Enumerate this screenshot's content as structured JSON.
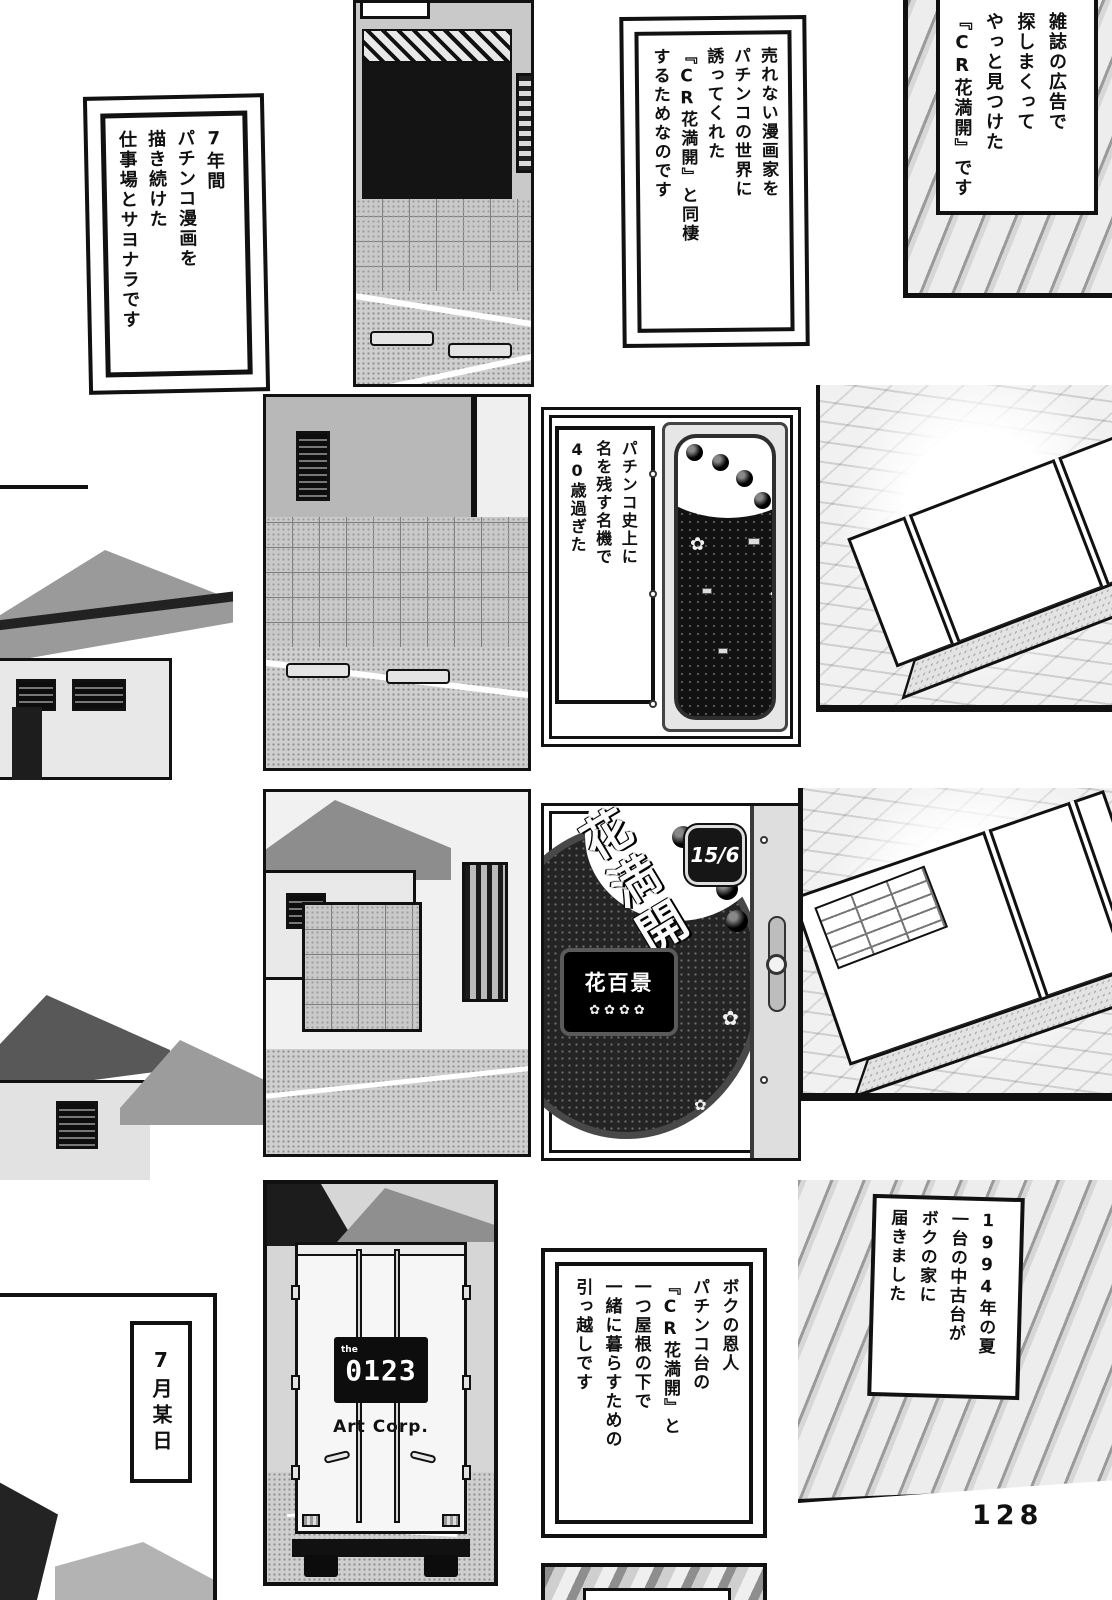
{
  "page": {
    "number": "128"
  },
  "colors": {
    "ink": "#111111",
    "paper": "#ffffff",
    "halftone_gray": "#c9c9c9",
    "dark_fill": "#1c1c1c"
  },
  "captions": {
    "magazine": "雑誌の広告で\n探しまくって\nやっと見つけた\n『CR花満開』です",
    "cohabit": "売れない漫画家を\nパチンコの世界に\n誘ってくれた\n『CR花満開』と同棲\nするためなのです",
    "goodbye": "7年間\nパチンコ漫画を\n描き続けた\n仕事場とサヨナラです",
    "famous_machine": "パチンコ史上に\n名を残す名機で\n40歳過ぎた",
    "delivery_1994": "1994年の夏\n一台の中古台が\nボクの家に\n届きました",
    "moving": "ボクの恩人\nパチンコ台の\n『CR花満開』と\n一つ屋根の下で\n一緒に暮らすための\n引っ越しです",
    "date": "7月某日"
  },
  "machine": {
    "logo": "花満開",
    "badge": "15/6",
    "display": "花百景",
    "reels": "✿✿✿✿"
  },
  "truck": {
    "logo_prefix": "the",
    "phone": "0123",
    "company": "Art Corp."
  }
}
